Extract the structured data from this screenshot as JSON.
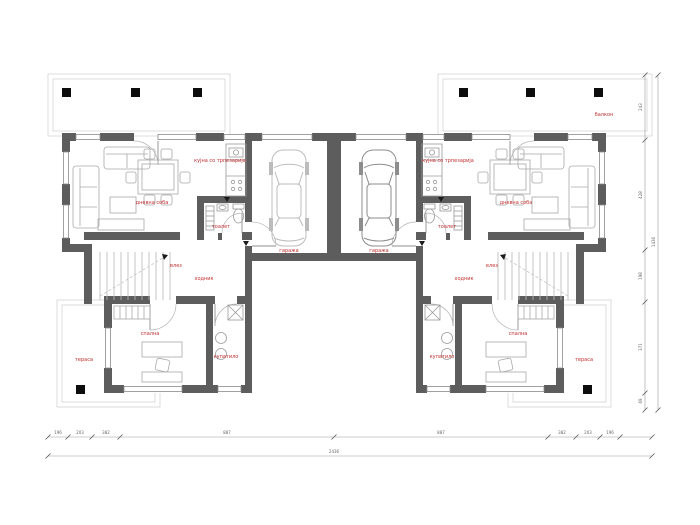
{
  "plan": {
    "type": "floor-plan",
    "colors": {
      "wall": "#5d5d5d",
      "room_label": "#c23030",
      "line": "#b8b8b8",
      "dimension": "#666666",
      "column": "#0d0d0d"
    },
    "rooms": {
      "living": "дневна соба",
      "kitchen": "кујна со трпезарија",
      "wc": "тоалет",
      "garage": "гаража",
      "entry": "влез",
      "hall": "ходник",
      "bedroom": "спална",
      "bath": "купатило",
      "terrace": "тераса",
      "balcony": "балкон"
    },
    "dims": {
      "bottom": [
        "196",
        "203",
        "382",
        "887",
        "887",
        "382",
        "203",
        "196"
      ],
      "bottom_total": "2436",
      "right": [
        "243",
        "428",
        "198",
        "371",
        "69"
      ],
      "right_total": "1436"
    }
  }
}
